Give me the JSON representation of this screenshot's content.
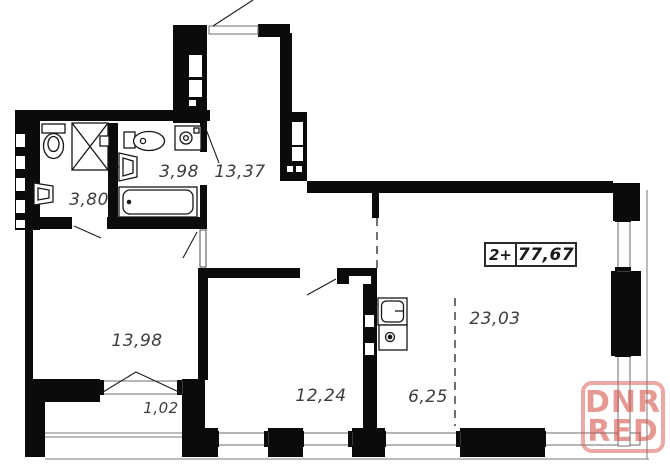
{
  "plan": {
    "type": "apartment-floor-plan",
    "info_box": {
      "rooms_label": "2+",
      "total_area": "77,67"
    },
    "rooms": [
      {
        "id": "bathroom-1",
        "area": "3,80"
      },
      {
        "id": "bathroom-2",
        "area": "3,98"
      },
      {
        "id": "hallway",
        "area": "13,37"
      },
      {
        "id": "bedroom",
        "area": "13,98"
      },
      {
        "id": "balcony",
        "area": "1,02"
      },
      {
        "id": "room-2",
        "area": "12,24"
      },
      {
        "id": "corridor",
        "area": "6,25"
      },
      {
        "id": "living-kitchen",
        "area": "23,03"
      }
    ],
    "watermark": {
      "line1": "DNR",
      "line2": "RED",
      "color": "#d5534b"
    },
    "colors": {
      "wall": "#0b0b0b",
      "thin_line": "#787878",
      "label_text": "#3d3d3d",
      "background": "#ffffff"
    }
  }
}
